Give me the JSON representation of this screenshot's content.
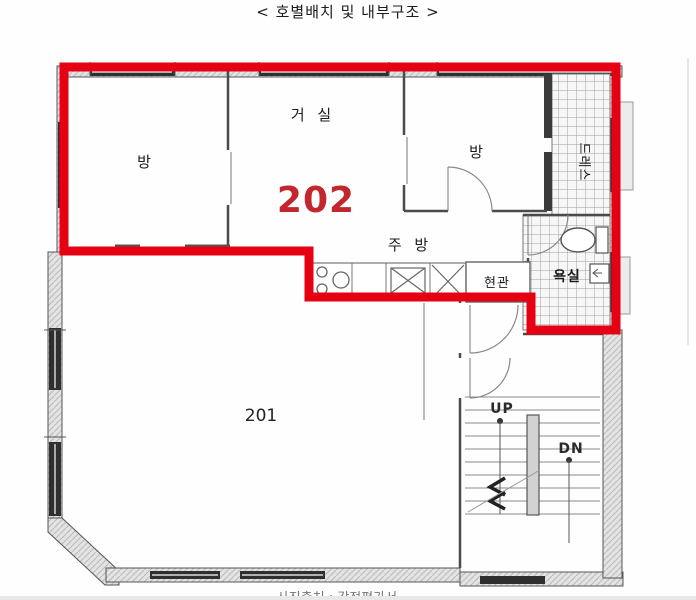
{
  "title": "< 호별배치 및 내부구조 >",
  "caption": "사진출처 : 감정평가서",
  "units": {
    "unit202": "202",
    "unit201": "201"
  },
  "rooms": {
    "room_left": "방",
    "living": "거 실",
    "room_right": "방",
    "kitchen": "주 방",
    "entrance": "현관",
    "bath": "욕실",
    "dress": "드레스"
  },
  "stairs": {
    "up": "UP",
    "dn": "DN"
  },
  "colors": {
    "boundary_red": "#e50012",
    "unit_number_red": "#c1272d",
    "wall_dark": "#4a4a4a",
    "wall_fill": "#e2e2e2",
    "window_dark": "#2f2f2f",
    "bottom_bar_gray": "#e8e8e8"
  }
}
